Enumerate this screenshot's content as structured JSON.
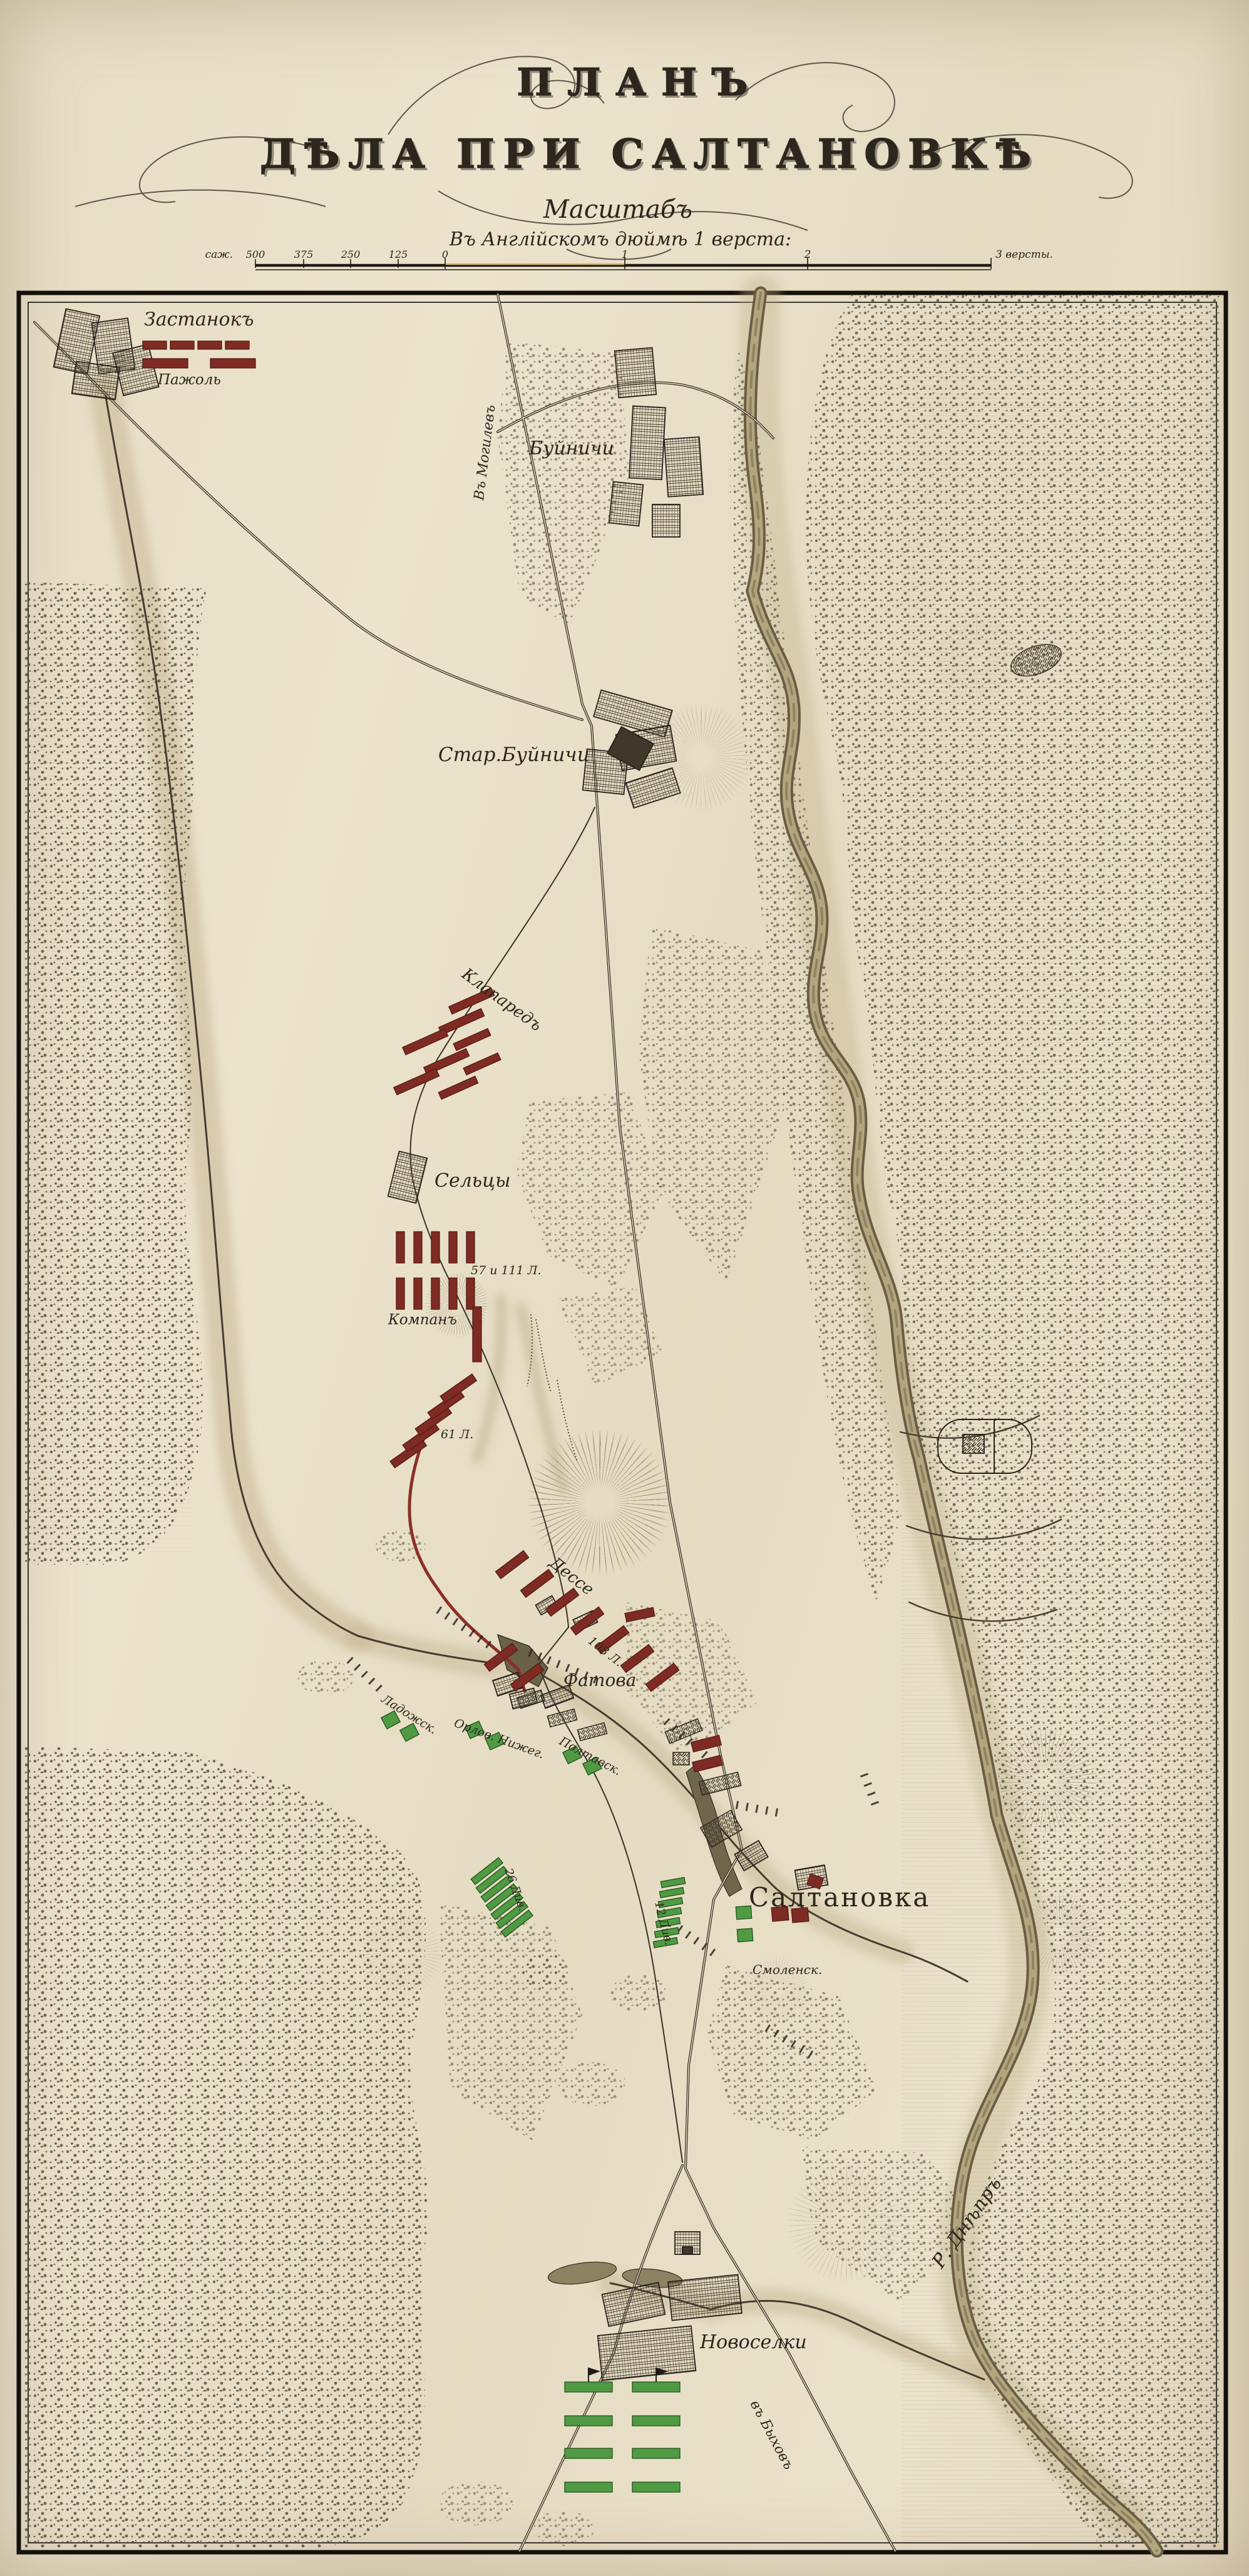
{
  "header": {
    "title_line1": "ПЛАНЪ",
    "title_line2": "ДѢЛА ПРИ САЛТАНОВКѢ",
    "scale_heading": "Масштабъ",
    "scale_note": "Въ Англійскомъ дюймѣ 1 верста:"
  },
  "scale_bar": {
    "unit_left": "саж.",
    "left_ticks": [
      "500",
      "375",
      "250",
      "125",
      "0"
    ],
    "mid_ticks": [
      "1",
      "2"
    ],
    "right_label": "3 версты."
  },
  "colors": {
    "paper": "#e9dfc8",
    "ink": "#2c261d",
    "french_units": "#7e2b23",
    "russian_units": "#4f9a43",
    "river": "#8d8161"
  },
  "map_labels": [
    {
      "id": "zastanok",
      "text": "Застанокъ"
    },
    {
      "id": "pajol",
      "text": "Пажоль"
    },
    {
      "id": "v-mogilev",
      "text": "Въ Могилевъ"
    },
    {
      "id": "buinichi",
      "text": "Буйничи"
    },
    {
      "id": "star-buinichi",
      "text": "Стар.Буйничи"
    },
    {
      "id": "klapared",
      "text": "Клапаредъ"
    },
    {
      "id": "seltsy",
      "text": "Сельцы"
    },
    {
      "id": "l57-111",
      "text": "57 и 111 Л."
    },
    {
      "id": "kompan",
      "text": "Компанъ"
    },
    {
      "id": "l61",
      "text": "61 Л."
    },
    {
      "id": "desse",
      "text": "Дессе"
    },
    {
      "id": "l108",
      "text": "108 Л."
    },
    {
      "id": "fatova",
      "text": "Фатова"
    },
    {
      "id": "ladozhsk",
      "text": "Ладожск."
    },
    {
      "id": "orlov-nizheg",
      "text": "Орлов. Нижег."
    },
    {
      "id": "poltavsk",
      "text": "Полтавск."
    },
    {
      "id": "saltanovka",
      "text": "Салтановка"
    },
    {
      "id": "smolensk",
      "text": "Смоленск."
    },
    {
      "id": "div26",
      "text": "26 Див."
    },
    {
      "id": "div12",
      "text": "12 Див."
    },
    {
      "id": "novoselki",
      "text": "Новоселки"
    },
    {
      "id": "v-byhov",
      "text": "въ Быховъ"
    },
    {
      "id": "r-dnepr",
      "text": "Р. Днѣпръ"
    }
  ]
}
